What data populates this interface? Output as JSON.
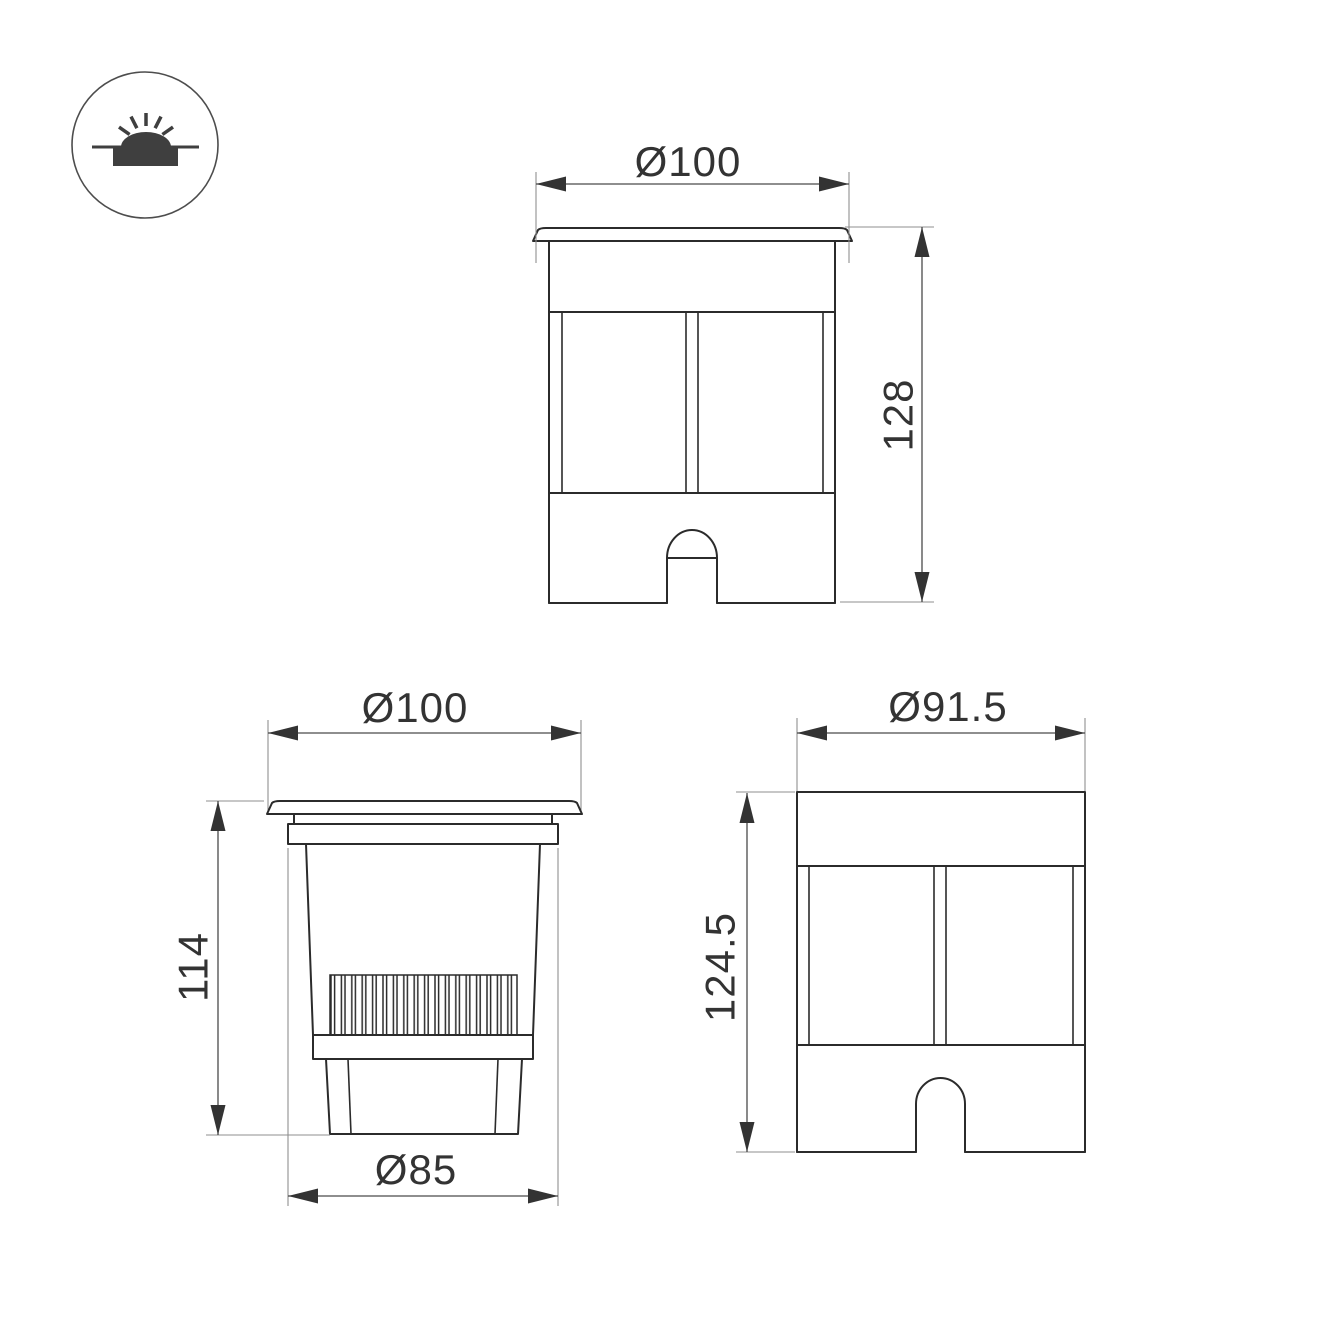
{
  "drawing": {
    "type": "technical-dimension-drawing",
    "product": "recessed in-ground luminaire",
    "views": {
      "front": {
        "diameter": "Ø100",
        "height": "128"
      },
      "section": {
        "diameter": "Ø100",
        "height": "114",
        "base_diameter": "Ø85"
      },
      "body": {
        "diameter": "Ø91.5",
        "height": "124.5"
      }
    },
    "icon": {
      "name": "inground-luminaire-icon"
    },
    "colors": {
      "background": "#ffffff",
      "outline": "#2b2b2b",
      "dimension_line": "#4a4a4a",
      "extension_line": "#8f8f8f",
      "label_text": "#333333",
      "icon_fill": "#3f3f3f"
    }
  }
}
